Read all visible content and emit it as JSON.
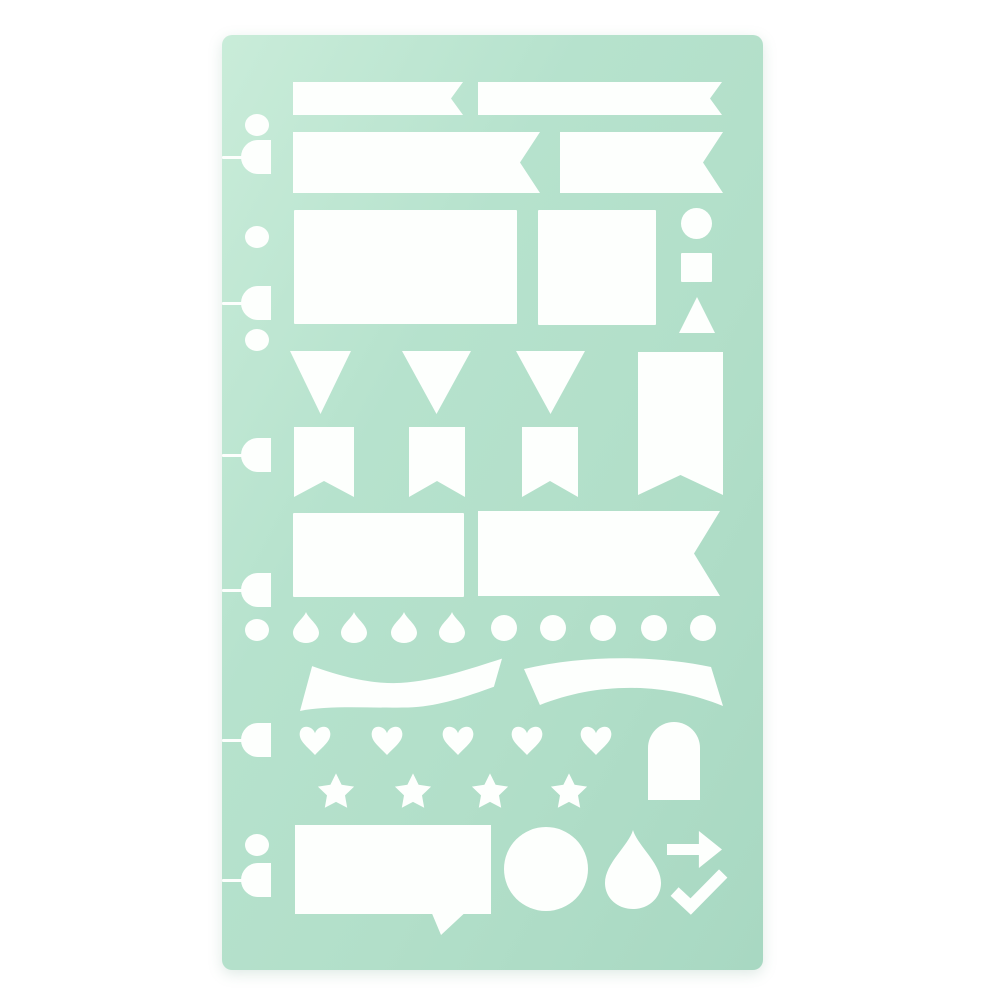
{
  "photo": {
    "subject": "mint green planner stencil sheet with white die-cut shapes",
    "background_color": "#ffffff"
  },
  "stencil": {
    "x": 222,
    "y": 35,
    "width": 541,
    "height": 935,
    "corner_radius": 10,
    "colors": {
      "base": "#b6e2cd",
      "highlight": "#c9ecd9",
      "mid": "#b2dfc9",
      "shadow": "#a8d8c2",
      "cutout": "#fdfffd"
    }
  },
  "cutouts": [
    {
      "name": "banner-strip-left-cutout",
      "type": "banner-notch",
      "x": 71,
      "y": 47,
      "w": 170,
      "h": 33,
      "notch": 12
    },
    {
      "name": "banner-strip-right-cutout",
      "type": "banner-notch",
      "x": 256,
      "y": 47,
      "w": 244,
      "h": 33,
      "notch": 12
    },
    {
      "name": "banner-wide-left-cutout",
      "type": "banner-notch",
      "x": 71,
      "y": 97,
      "w": 247,
      "h": 61,
      "notch": 20
    },
    {
      "name": "banner-wide-right-cutout",
      "type": "banner-notch",
      "x": 338,
      "y": 97,
      "w": 163,
      "h": 61,
      "notch": 20
    },
    {
      "name": "rectangle-large-cutout",
      "type": "rect",
      "x": 72,
      "y": 175,
      "w": 223,
      "h": 114
    },
    {
      "name": "rectangle-medium-cutout",
      "type": "rect",
      "x": 316,
      "y": 175,
      "w": 118,
      "h": 115
    },
    {
      "name": "small-circle-cutout",
      "type": "ellipse",
      "x": 459,
      "y": 173,
      "w": 31,
      "h": 31
    },
    {
      "name": "small-square-cutout",
      "type": "rect",
      "x": 459,
      "y": 218,
      "w": 31,
      "h": 29
    },
    {
      "name": "small-triangle-cutout",
      "type": "triangle-up",
      "x": 457,
      "y": 262,
      "w": 36,
      "h": 36
    },
    {
      "name": "pennant-triangle-1-cutout",
      "type": "pennant-down",
      "x": 68,
      "y": 316,
      "w": 61,
      "h": 63
    },
    {
      "name": "pennant-triangle-2-cutout",
      "type": "pennant-down",
      "x": 180,
      "y": 316,
      "w": 69,
      "h": 63
    },
    {
      "name": "pennant-triangle-3-cutout",
      "type": "pennant-down",
      "x": 294,
      "y": 316,
      "w": 69,
      "h": 63
    },
    {
      "name": "tall-swallowtail-flag-cutout",
      "type": "flag-swallowtail",
      "x": 416,
      "y": 317,
      "w": 85,
      "h": 143,
      "notch": 20
    },
    {
      "name": "swallowtail-flag-1-cutout",
      "type": "flag-swallowtail",
      "x": 72,
      "y": 392,
      "w": 60,
      "h": 70,
      "notch": 16
    },
    {
      "name": "swallowtail-flag-2-cutout",
      "type": "flag-swallowtail",
      "x": 187,
      "y": 392,
      "w": 56,
      "h": 70,
      "notch": 16
    },
    {
      "name": "swallowtail-flag-3-cutout",
      "type": "flag-swallowtail",
      "x": 300,
      "y": 392,
      "w": 56,
      "h": 70,
      "notch": 16
    },
    {
      "name": "rectangle-wide-cutout",
      "type": "rect",
      "x": 71,
      "y": 478,
      "w": 171,
      "h": 84
    },
    {
      "name": "banner-large-cutout",
      "type": "banner-notch",
      "x": 256,
      "y": 476,
      "w": 242,
      "h": 85,
      "notch": 26
    },
    {
      "name": "teardrop-small-1-cutout",
      "type": "teardrop",
      "x": 71,
      "y": 577,
      "w": 26,
      "h": 31
    },
    {
      "name": "teardrop-small-2-cutout",
      "type": "teardrop",
      "x": 119,
      "y": 577,
      "w": 26,
      "h": 31
    },
    {
      "name": "teardrop-small-3-cutout",
      "type": "teardrop",
      "x": 169,
      "y": 577,
      "w": 26,
      "h": 31
    },
    {
      "name": "teardrop-small-4-cutout",
      "type": "teardrop",
      "x": 217,
      "y": 577,
      "w": 26,
      "h": 31
    },
    {
      "name": "dot-1-cutout",
      "type": "ellipse",
      "x": 269,
      "y": 580,
      "w": 26,
      "h": 26
    },
    {
      "name": "dot-2-cutout",
      "type": "ellipse",
      "x": 318,
      "y": 580,
      "w": 26,
      "h": 26
    },
    {
      "name": "dot-3-cutout",
      "type": "ellipse",
      "x": 368,
      "y": 580,
      "w": 26,
      "h": 26
    },
    {
      "name": "dot-4-cutout",
      "type": "ellipse",
      "x": 419,
      "y": 580,
      "w": 26,
      "h": 26
    },
    {
      "name": "dot-5-cutout",
      "type": "ellipse",
      "x": 468,
      "y": 580,
      "w": 26,
      "h": 26
    },
    {
      "name": "wave-ribbon-cutout",
      "type": "ribbon-wave",
      "x": 78,
      "y": 622,
      "w": 202,
      "h": 54
    },
    {
      "name": "arc-ribbon-cutout",
      "type": "ribbon-arc",
      "x": 302,
      "y": 623,
      "w": 199,
      "h": 50
    },
    {
      "name": "heart-1-cutout",
      "type": "heart",
      "x": 76,
      "y": 689,
      "w": 34,
      "h": 31
    },
    {
      "name": "heart-2-cutout",
      "type": "heart",
      "x": 148,
      "y": 689,
      "w": 34,
      "h": 31
    },
    {
      "name": "heart-3-cutout",
      "type": "heart",
      "x": 219,
      "y": 689,
      "w": 34,
      "h": 31
    },
    {
      "name": "heart-4-cutout",
      "type": "heart",
      "x": 288,
      "y": 689,
      "w": 34,
      "h": 31
    },
    {
      "name": "heart-5-cutout",
      "type": "heart",
      "x": 357,
      "y": 689,
      "w": 34,
      "h": 31
    },
    {
      "name": "arch-cutout",
      "type": "arch",
      "x": 426,
      "y": 687,
      "w": 52,
      "h": 78
    },
    {
      "name": "star-1-cutout",
      "type": "star",
      "x": 95,
      "y": 738,
      "w": 38,
      "h": 36
    },
    {
      "name": "star-2-cutout",
      "type": "star",
      "x": 172,
      "y": 738,
      "w": 38,
      "h": 36
    },
    {
      "name": "star-3-cutout",
      "type": "star",
      "x": 249,
      "y": 738,
      "w": 38,
      "h": 36
    },
    {
      "name": "star-4-cutout",
      "type": "star",
      "x": 328,
      "y": 738,
      "w": 38,
      "h": 36
    },
    {
      "name": "speech-bubble-cutout",
      "type": "speech-bubble",
      "x": 73,
      "y": 790,
      "w": 196,
      "h": 110,
      "notch": 21
    },
    {
      "name": "circle-large-cutout",
      "type": "ellipse",
      "x": 282,
      "y": 792,
      "w": 84,
      "h": 84
    },
    {
      "name": "teardrop-large-cutout",
      "type": "teardrop",
      "x": 383,
      "y": 795,
      "w": 56,
      "h": 79
    },
    {
      "name": "arrow-right-cutout",
      "type": "arrow-right",
      "x": 445,
      "y": 796,
      "w": 55,
      "h": 37
    },
    {
      "name": "checkmark-cutout",
      "type": "checkmark",
      "x": 452,
      "y": 838,
      "w": 49,
      "h": 39
    }
  ],
  "binding_punches": {
    "circle": {
      "cx": 35,
      "rx": 12,
      "ry": 11
    },
    "circle_cy": [
      90,
      202,
      305,
      595,
      810
    ],
    "tab": {
      "x": 19,
      "w": 30,
      "h": 34
    },
    "tab_cy": [
      122,
      268,
      420,
      555,
      705,
      845
    ],
    "slit": {
      "h": 3
    }
  }
}
